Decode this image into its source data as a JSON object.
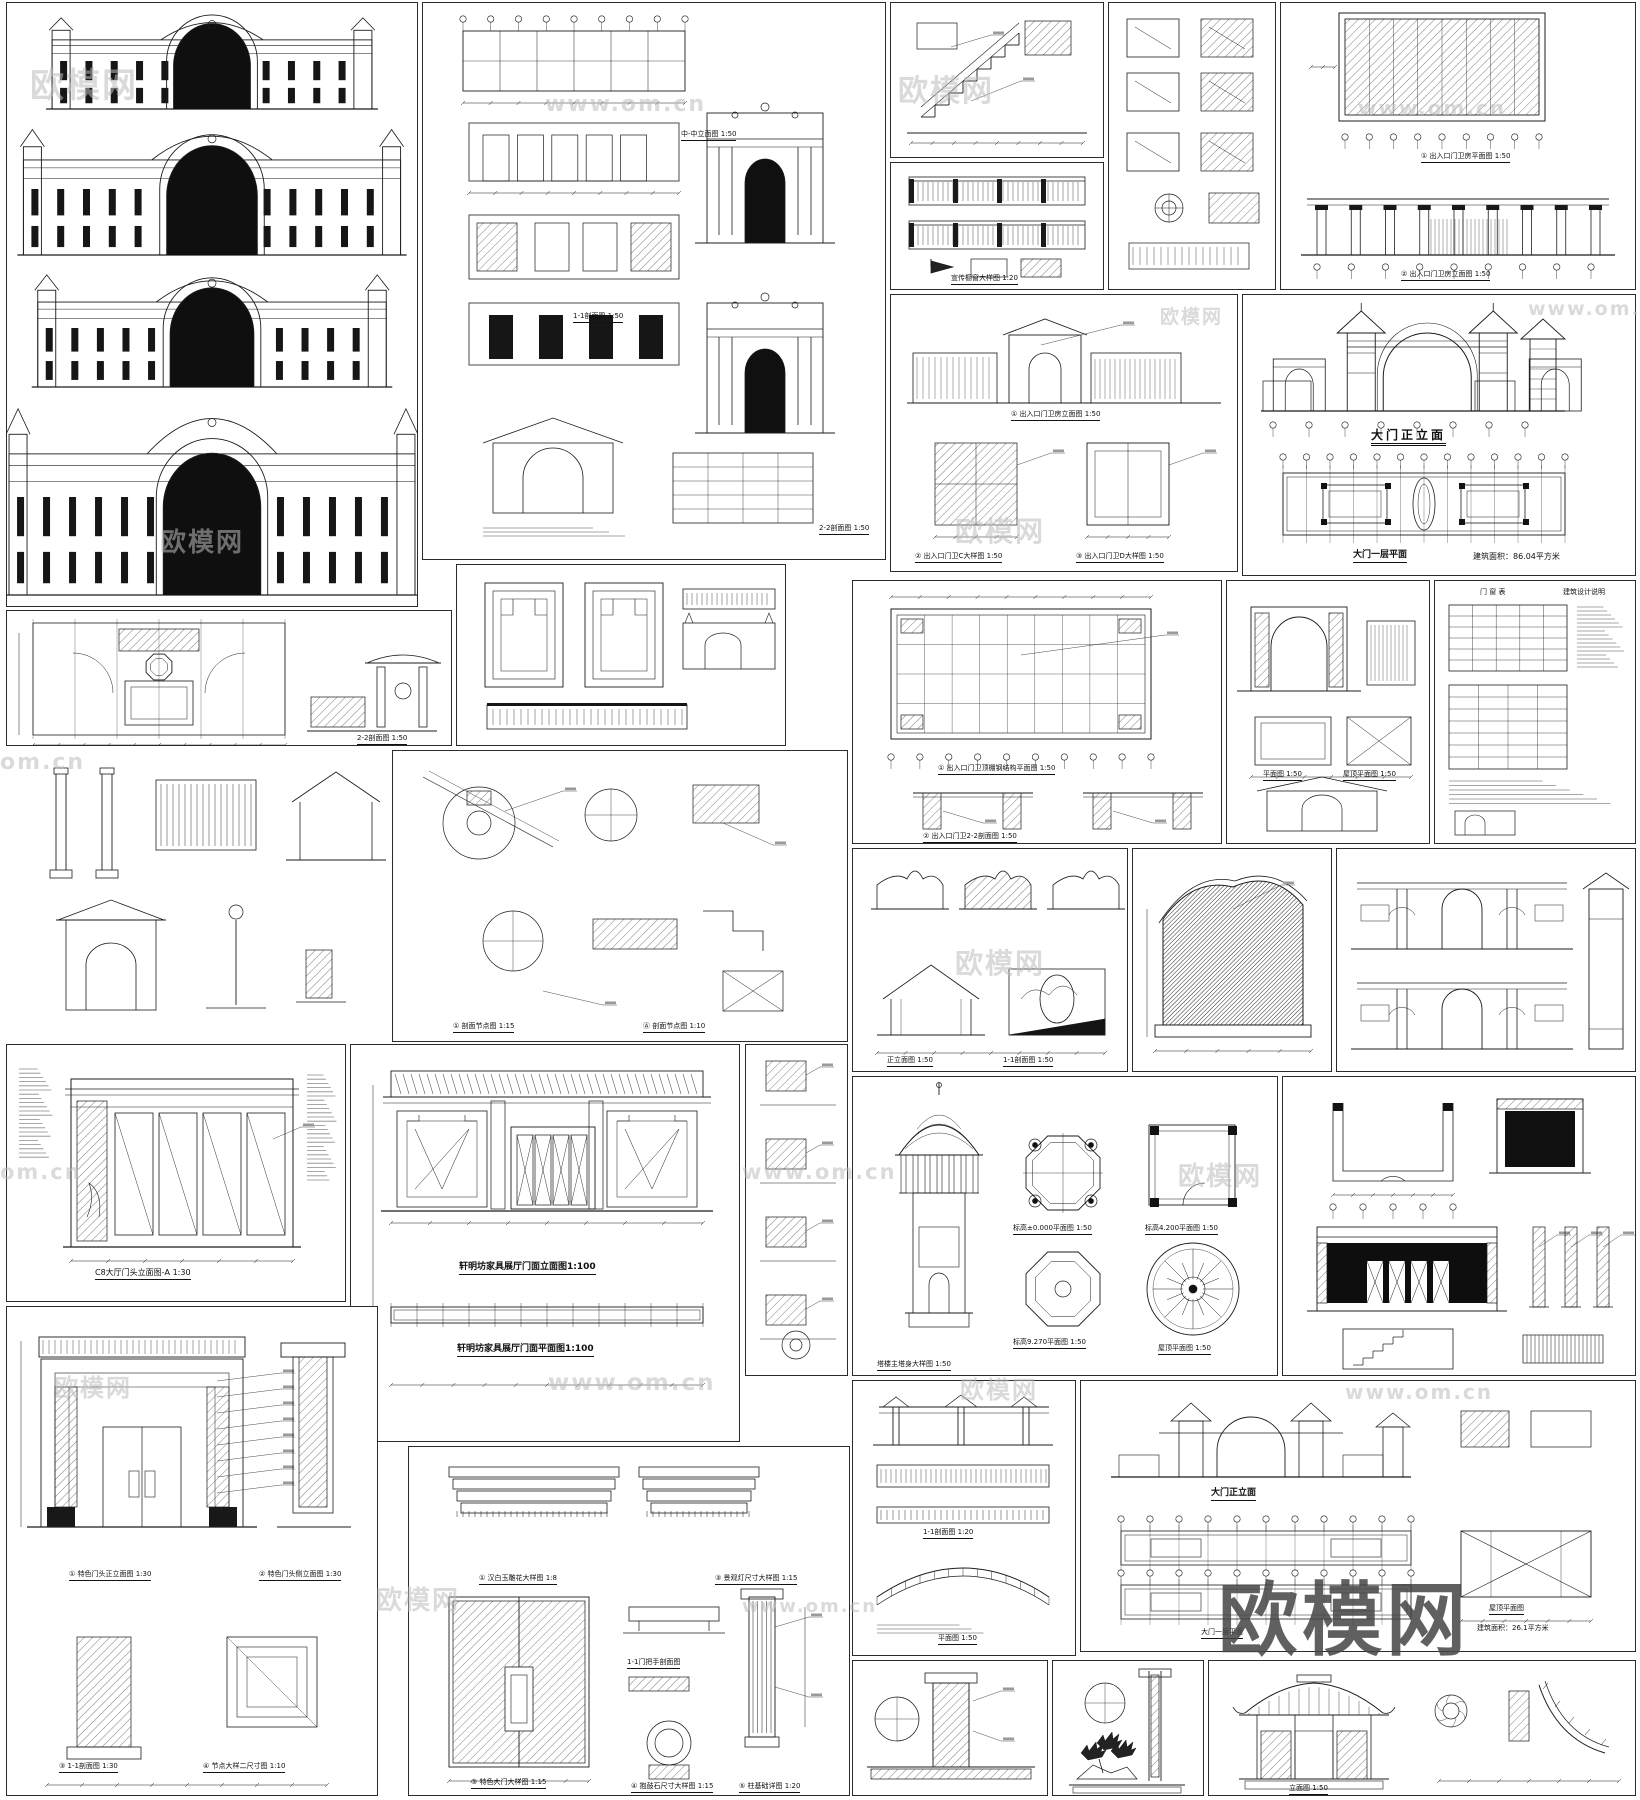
{
  "watermarks": {
    "brand": "欧模网",
    "url": "www.om.cn",
    "url_short": "om.cn",
    "big": "欧模网"
  },
  "panels": {
    "B": {
      "c1": "中-中立面图 1:50",
      "c2": "1-1剖面图 1:50",
      "c3": "2-2剖面图 1:50"
    },
    "C2": {
      "c1": "宣传橱窗大样图 1:20"
    },
    "D": {
      "c1": "① 出入口门卫房平面图 1:50",
      "c2": "② 出入口门卫房立面图 1:50"
    },
    "E": {
      "c1": "① 出入口门卫房立面图 1:50",
      "c2": "② 出入口门卫C大样图 1:50",
      "c3": "③ 出入口门卫D大样图 1:50"
    },
    "F": {
      "c1": "大门正立面",
      "c2": "大门一层平面",
      "c3": "建筑面积：86.04平方米"
    },
    "G": {
      "c1": "① 出入口门卫顶棚钢结构平面图 1:50",
      "c2": "② 出入口门卫2-2剖面图 1:50"
    },
    "H": {
      "c1": "平面图 1:50",
      "c2": "屋顶平面图 1:50"
    },
    "H2": {
      "c1": "门 窗 表",
      "c2": "建筑设计说明"
    },
    "I": {
      "c1": "2-2剖面图 1:50"
    },
    "J": {
      "c1": "① 剖面节点图 1:15",
      "c2": "Ⓐ 剖面节点图 1:10"
    },
    "M": {
      "c1": "正立面图 1:50",
      "c2": "1-1剖面图 1:50"
    },
    "O": {
      "c1": "标高±0.000平面图 1:50",
      "c2": "标高4.200平面图 1:50",
      "c3": "标高9.270平面图 1:50",
      "c4": "屋顶平面图 1:50",
      "c5": "塔楼主塔身大样图 1:50"
    },
    "Q": {
      "c1": "C8大厅门头立面图-A 1:30"
    },
    "R": {
      "c1": "轩明坊家具展厅门面立面图1:100",
      "c2": "轩明坊家具展厅门面平面图1:100"
    },
    "S": {
      "c1": "平面图 1:50",
      "c2": "1-1剖面图 1:20"
    },
    "T": {
      "c1": "大门正立面",
      "c2": "大门一层平面",
      "c3": "屋顶平面图",
      "c4": "建筑面积：26.1平方米"
    },
    "U": {
      "c1": "① 特色门头正立面图 1:30",
      "c2": "② 特色门头侧立面图 1:30",
      "c3": "③ 1-1剖面图 1:30",
      "c4": "④ 节点大样二尺寸图 1:10"
    },
    "V": {
      "c1": "① 汉白玉雕花大样图 1:8",
      "c2": "③ 特色大门大样图 1:15",
      "c3": "1-1门把手剖面图",
      "c4": "④ 抱鼓石尺寸大样图 1:15",
      "c5": "⑤ 柱基础详图 1:20",
      "c6": "③ 景观灯尺寸大样图 1:15"
    },
    "X2": {
      "c1": "立面图 1:50"
    }
  }
}
